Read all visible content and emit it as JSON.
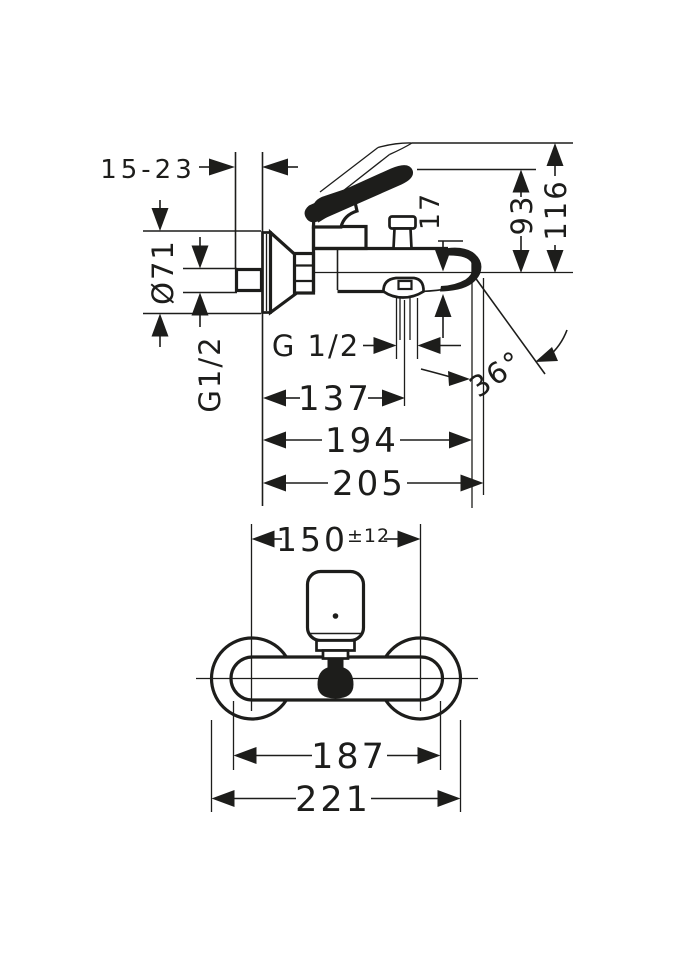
{
  "drawing": {
    "colors": {
      "line": "#1d1d1b",
      "background": "#ffffff"
    },
    "side_view": {
      "wall_offset": "15-23",
      "escutcheon_diameter": "Ø71",
      "wall_connection_thread": "G1/2",
      "spout_outlet_drop": "17",
      "spout_height": "93",
      "max_height": "116",
      "aerator_thread": "G 1/2",
      "reach_to_aerator": "137",
      "reach_to_spout_tip": "194",
      "max_reach": "205",
      "spout_angle": "36°"
    },
    "front_view": {
      "connection_spacing": "150",
      "connection_tolerance": "±12",
      "body_width": "187",
      "overall_width": "221"
    }
  }
}
